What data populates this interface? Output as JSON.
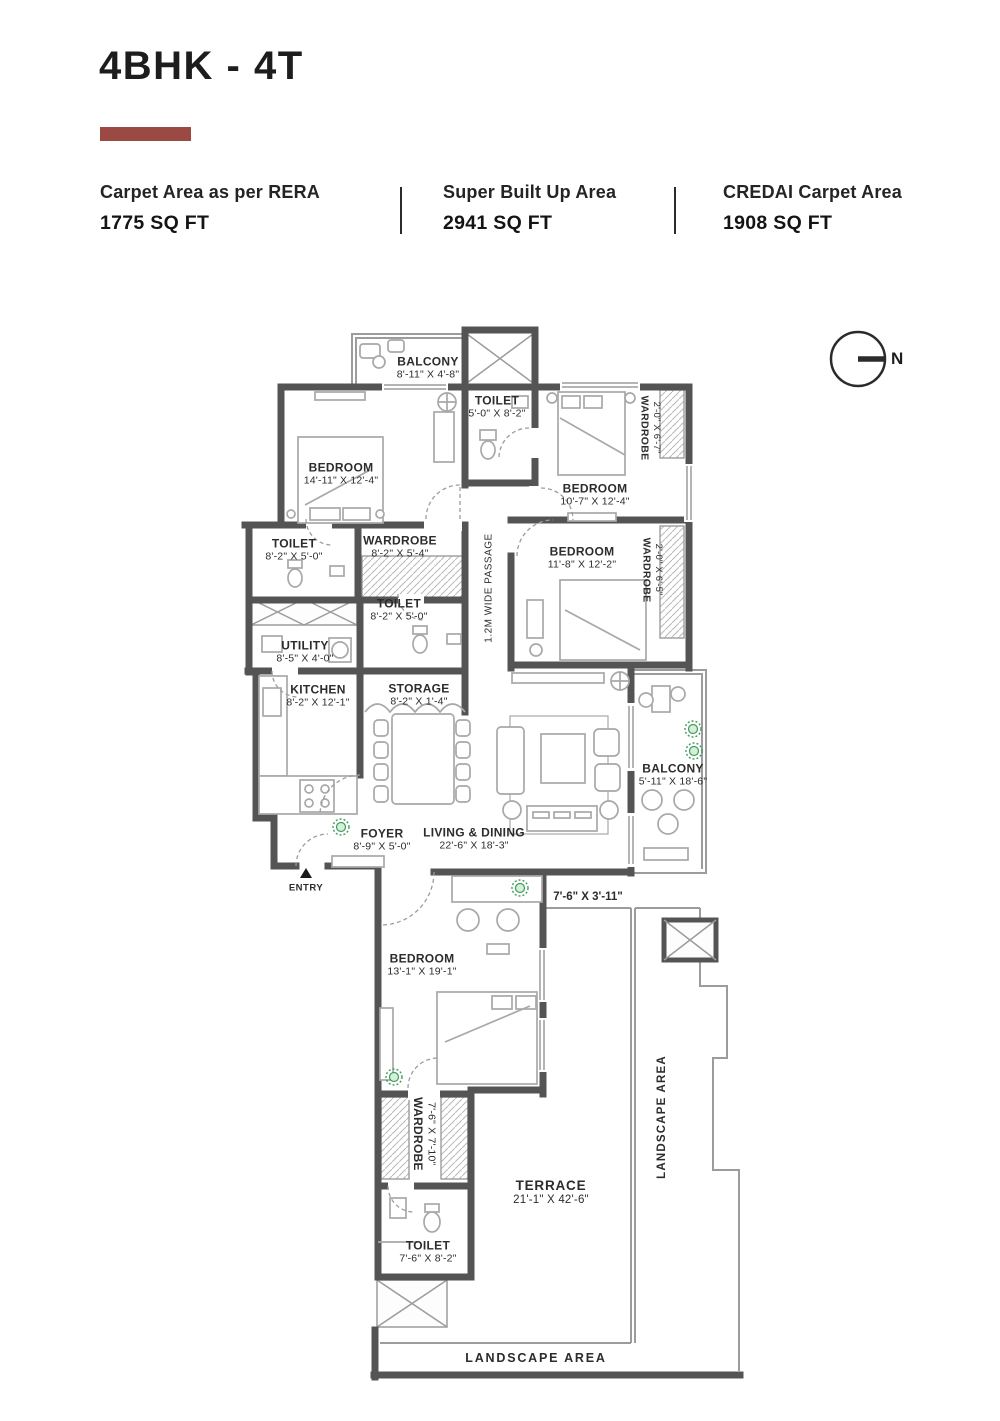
{
  "header": {
    "title": "4BHK - 4T",
    "accent_color": "#9a4a42",
    "stats": [
      {
        "label": "Carpet Area as per RERA",
        "value": "1775 SQ FT"
      },
      {
        "label": "Super Built Up Area",
        "value": "2941 SQ FT"
      },
      {
        "label": "CREDAI Carpet Area",
        "value": "1908 SQ FT"
      }
    ]
  },
  "compass": {
    "north_label": "N"
  },
  "plan": {
    "wall_color": "#545454",
    "line_color": "#9c9c9c",
    "plant_color": "#3f9e58",
    "rooms": [
      {
        "id": "balcony-top",
        "name": "BALCONY",
        "dims": "8'-11\" X 4'-8\""
      },
      {
        "id": "toilet-top",
        "name": "TOILET",
        "dims": "5'-0\" X 8'-2\""
      },
      {
        "id": "bedroom-1",
        "name": "BEDROOM",
        "dims": "14'-11\" X 12'-4\""
      },
      {
        "id": "wardrobe-b2",
        "name": "WARDROBE",
        "dims": "2'-0\" X 6'-7\""
      },
      {
        "id": "bedroom-2",
        "name": "BEDROOM",
        "dims": "10'-7\" X 12'-4\""
      },
      {
        "id": "toilet-left",
        "name": "TOILET",
        "dims": "8'-2\" X 5'-0\""
      },
      {
        "id": "wardrobe-mid",
        "name": "WARDROBE",
        "dims": "8'-2\" X 5'-4\""
      },
      {
        "id": "toilet-mid",
        "name": "TOILET",
        "dims": "8'-2\" X 5'-0\""
      },
      {
        "id": "bedroom-3",
        "name": "BEDROOM",
        "dims": "11'-8\" X 12'-2\""
      },
      {
        "id": "wardrobe-b3",
        "name": "WARDROBE",
        "dims": "2'-0\" X 6'-5\""
      },
      {
        "id": "utility",
        "name": "UTILITY",
        "dims": "8'-5\" X 4'-0\""
      },
      {
        "id": "kitchen",
        "name": "KITCHEN",
        "dims": "8'-2\" X 12'-1\""
      },
      {
        "id": "storage",
        "name": "STORAGE",
        "dims": "8'-2\" X 1'-4\""
      },
      {
        "id": "foyer",
        "name": "FOYER",
        "dims": "8'-9\" X 5'-0\""
      },
      {
        "id": "living-dining",
        "name": "LIVING & DINING",
        "dims": "22'-6\" X 18'-3\""
      },
      {
        "id": "balcony-right",
        "name": "BALCONY",
        "dims": "5'-11\" X 18'-6\""
      },
      {
        "id": "bedroom-4",
        "name": "BEDROOM",
        "dims": "13'-1\" X 19'-1\""
      },
      {
        "id": "wardrobe-bottom",
        "name": "WARDROBE",
        "dims": "7'-6\" X 7'-10\""
      },
      {
        "id": "toilet-bottom",
        "name": "TOILET",
        "dims": "7'-6\" X 8'-2\""
      },
      {
        "id": "terrace",
        "name": "TERRACE",
        "dims": "21'-1\" X 42'-6\""
      }
    ],
    "annotations": {
      "passage": "1.2M WIDE PASSAGE",
      "deck_dims": "7'-6\" X 3'-11\"",
      "entry": "ENTRY",
      "landscape_right": "LANDSCAPE AREA",
      "landscape_bottom": "LANDSCAPE AREA"
    }
  }
}
